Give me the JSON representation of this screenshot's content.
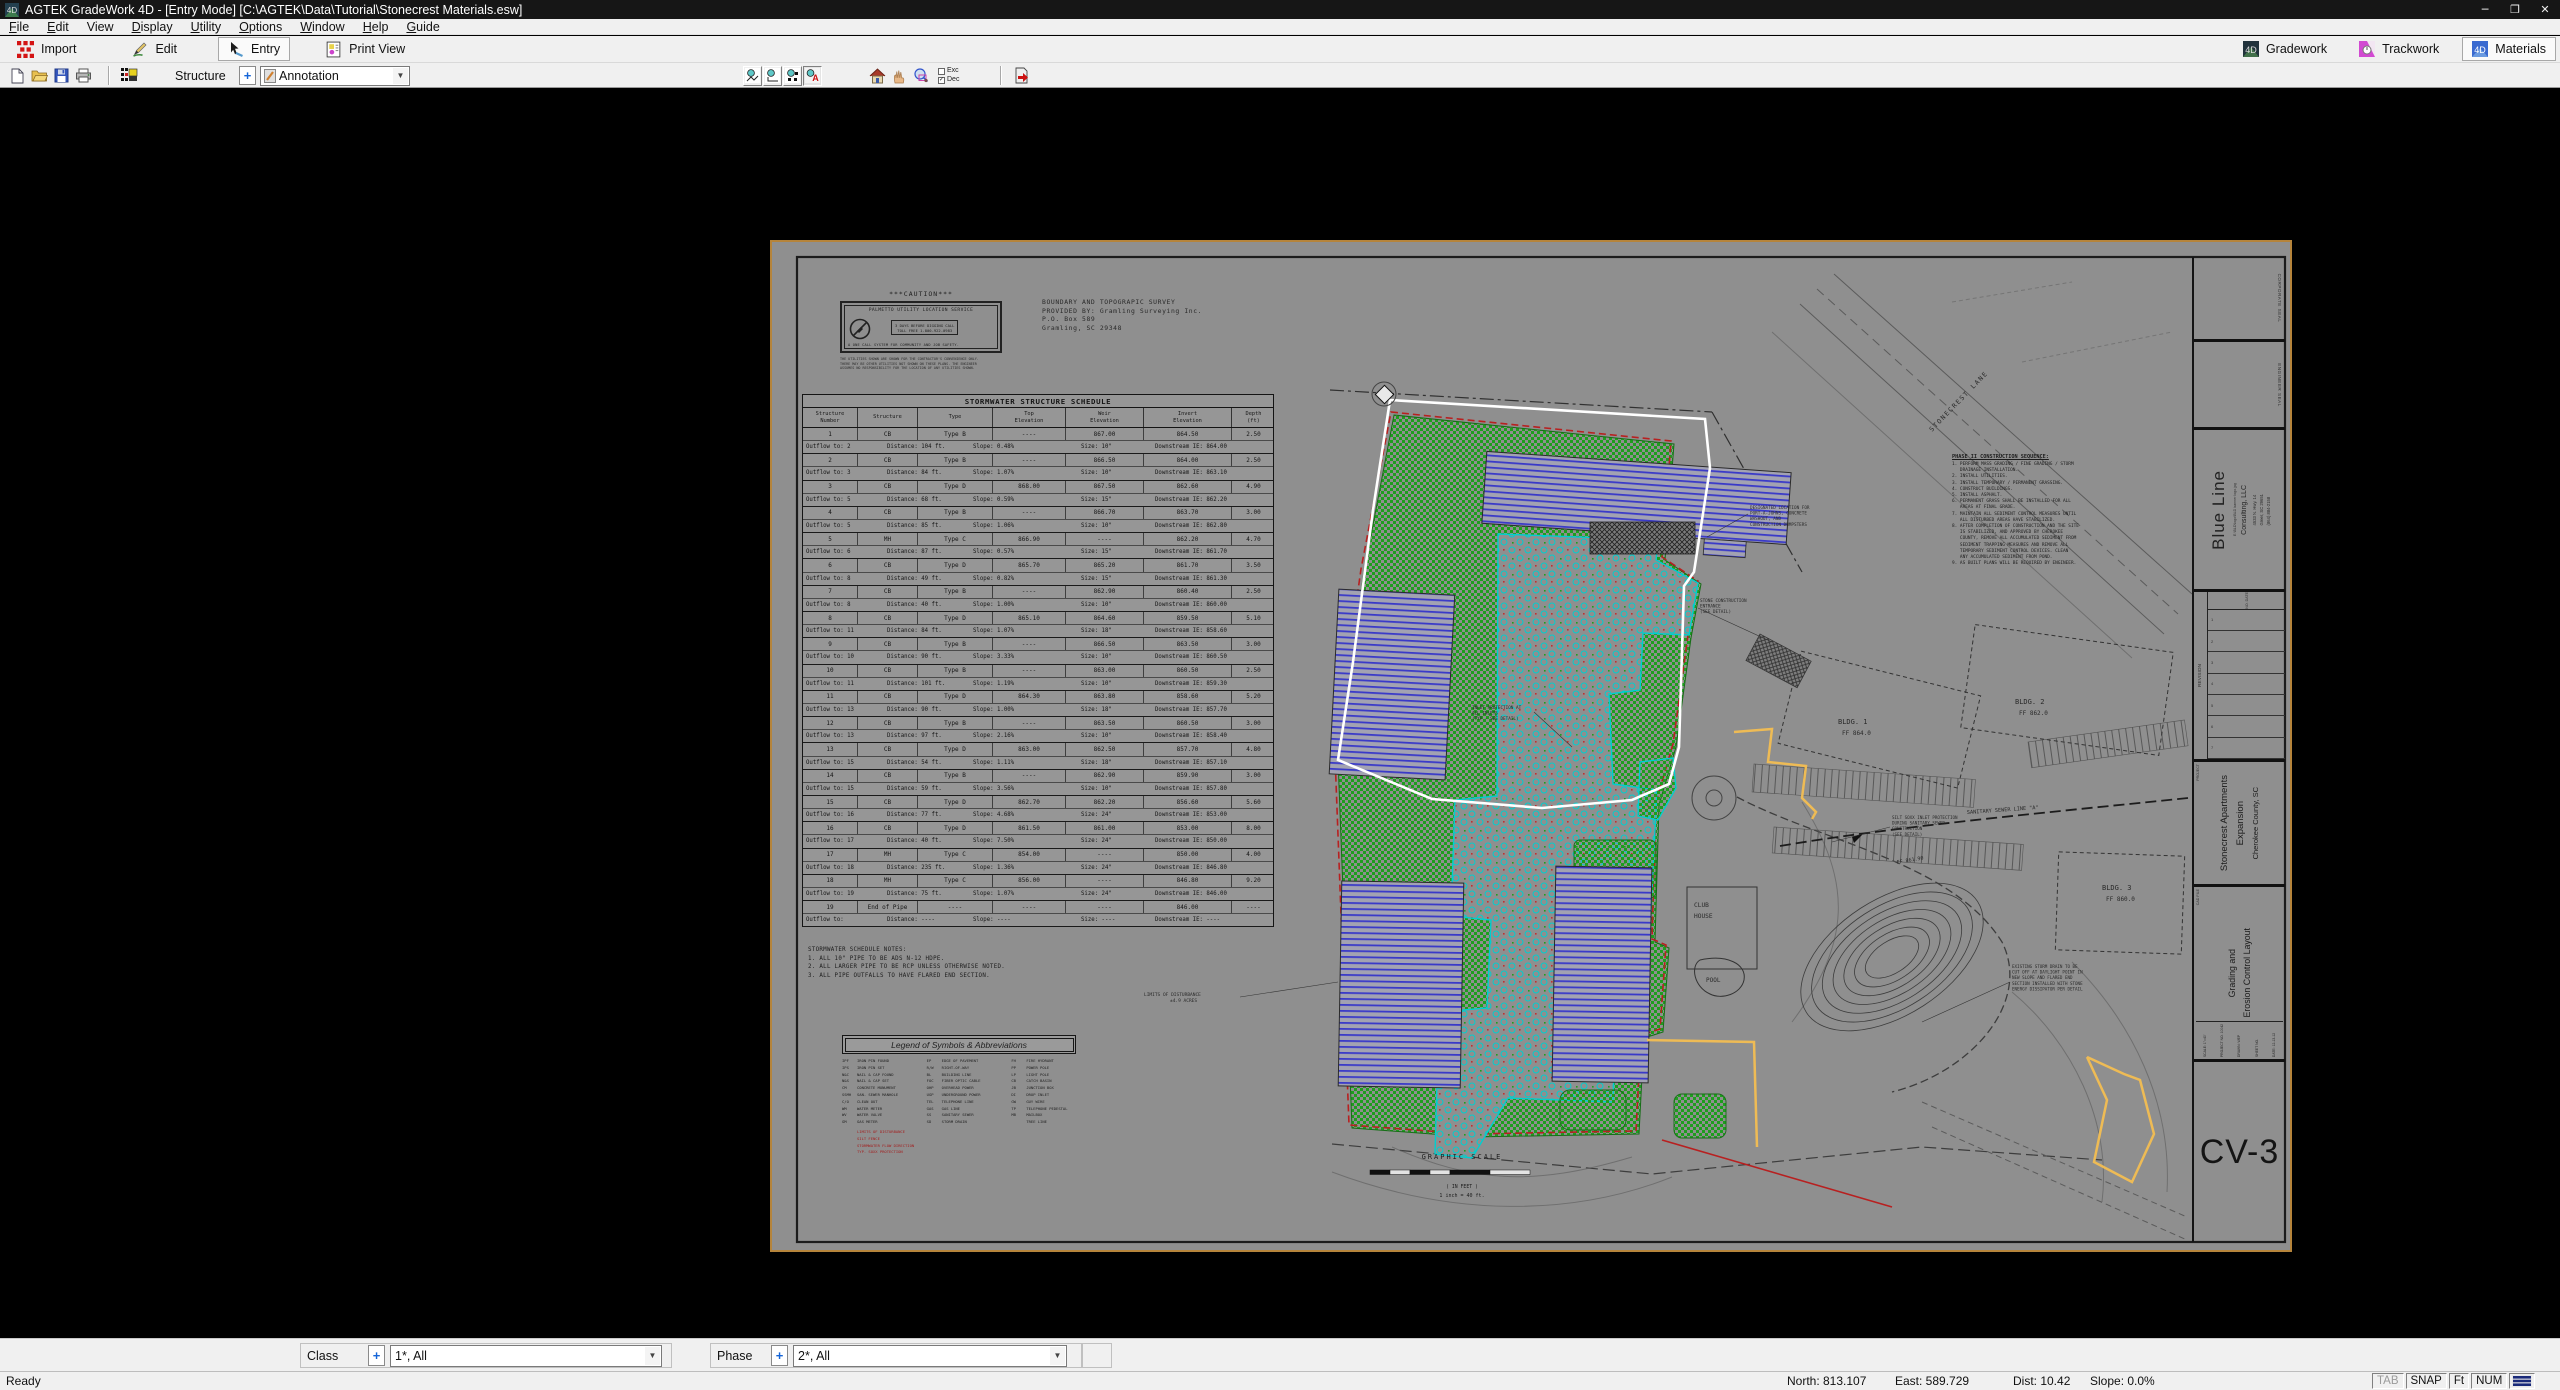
{
  "window": {
    "title": "AGTEK GradeWork 4D - [Entry Mode]  [C:\\AGTEK\\Data\\Tutorial\\Stonecrest Materials.esw]",
    "minimize": "─",
    "maximize": "❐",
    "close": "✕"
  },
  "menus": [
    {
      "u": "F",
      "rest": "ile"
    },
    {
      "u": "E",
      "rest": "dit"
    },
    {
      "u": "",
      "rest": "View"
    },
    {
      "u": "D",
      "rest": "isplay"
    },
    {
      "u": "U",
      "rest": "tility"
    },
    {
      "u": "O",
      "rest": "ptions"
    },
    {
      "u": "W",
      "rest": "indow"
    },
    {
      "u": "H",
      "rest": "elp"
    },
    {
      "u": "G",
      "rest": "uide"
    }
  ],
  "toolbar": {
    "import": "Import",
    "edit": "Edit",
    "entry": "Entry",
    "print_view": "Print View",
    "gradework": "Gradework",
    "trackwork": "Trackwork",
    "materials": "Materials"
  },
  "entrybar": {
    "structure_label": "Structure",
    "plus": "+",
    "layer_value": "Annotation",
    "exc": "Exc",
    "dec": "Dec",
    "dec_check": "✓",
    "arrow": "▼"
  },
  "bottombar": {
    "class_label": "Class",
    "class_value": "1*, All",
    "phase_label": "Phase",
    "phase_value": "2*, All",
    "plus": "+",
    "arrow": "▼"
  },
  "status": {
    "ready": "Ready",
    "north": "North: 813.107",
    "east": "East: 589.729",
    "dist": "Dist: 10.42",
    "slope": "Slope: 0.0%",
    "tab": "TAB",
    "snap": "SNAP",
    "ft": "Ft",
    "num": "NUM"
  },
  "colors": {
    "seed_green": "#1e9e1e",
    "pavement_cyan": "#00cfcf",
    "silt_fence_red": "#b82020",
    "annotation_yellow": "#eebb55",
    "takeoff_white": "#ffffff",
    "sheet_frame": "#b5843b",
    "building_stripe_blue": "#3a3ac8"
  },
  "sheet": {
    "caution": {
      "title": "***CAUTION***",
      "service": "PALMETTO UTILITY LOCATION SERVICE",
      "call1": "3 DAYS BEFORE DIGGING CALL",
      "call2": "TOLL FREE 1-800-922-0983",
      "footer": "A ONE CALL SYSTEM FOR COMMUNITY AND JOB SAFETY.",
      "smallprint": [
        "THE UTILITIES SHOWN ARE SHOWN FOR THE CONTRACTOR'S CONVENIENCE ONLY.",
        "THERE MAY BE OTHER UTILITIES NOT SHOWN ON THESE PLANS. THE ENGINEER",
        "ASSUMES NO RESPONSIBILITY FOR THE LOCATION OF ANY UTILITIES SHOWN."
      ]
    },
    "survey": [
      "BOUNDARY AND TOPOGRAPIC SURVEY",
      "PROVIDED BY: Gramling Surveying Inc.",
      "P.O. Box 589",
      "Gramling, SC 29348"
    ],
    "schedule": {
      "title": "STORMWATER STRUCTURE SCHEDULE",
      "headers": [
        {
          "l1": "Structure",
          "l2": "Number"
        },
        {
          "l1": "",
          "l2": "Structure"
        },
        {
          "l1": "",
          "l2": "Type"
        },
        {
          "l1": "Top",
          "l2": "Elevation"
        },
        {
          "l1": "Weir",
          "l2": "Elevation"
        },
        {
          "l1": "Invert",
          "l2": "Elevation"
        },
        {
          "l1": "Depth",
          "l2": "(ft)"
        }
      ],
      "rows": [
        {
          "n": "1",
          "s": "CB",
          "t": "Type B",
          "top": "----",
          "weir": "867.00",
          "inv": "864.50",
          "d": "2.50",
          "o": [
            "Outflow to:   2",
            "Distance: 104 ft.",
            "Slope: 0.48%",
            "Size: 10\"",
            "Downstream IE: 864.00"
          ]
        },
        {
          "n": "2",
          "s": "CB",
          "t": "Type B",
          "top": "----",
          "weir": "866.50",
          "inv": "864.00",
          "d": "2.50",
          "o": [
            "Outflow to:   3",
            "Distance: 84 ft.",
            "Slope: 1.07%",
            "Size: 10\"",
            "Downstream IE: 863.10"
          ]
        },
        {
          "n": "3",
          "s": "CB",
          "t": "Type D",
          "top": "868.00",
          "weir": "867.50",
          "inv": "862.60",
          "d": "4.90",
          "o": [
            "Outflow to:   5",
            "Distance: 68 ft.",
            "Slope: 0.59%",
            "Size: 15\"",
            "Downstream IE: 862.20"
          ]
        },
        {
          "n": "4",
          "s": "CB",
          "t": "Type B",
          "top": "----",
          "weir": "866.70",
          "inv": "863.70",
          "d": "3.00",
          "o": [
            "Outflow to:   5",
            "Distance: 85 ft.",
            "Slope: 1.06%",
            "Size: 10\"",
            "Downstream IE: 862.80"
          ]
        },
        {
          "n": "5",
          "s": "MH",
          "t": "Type C",
          "top": "866.90",
          "weir": "----",
          "inv": "862.20",
          "d": "4.70",
          "o": [
            "Outflow to:   6",
            "Distance: 87 ft.",
            "Slope: 0.57%",
            "Size: 15\"",
            "Downstream IE: 861.70"
          ]
        },
        {
          "n": "6",
          "s": "CB",
          "t": "Type D",
          "top": "865.70",
          "weir": "865.20",
          "inv": "861.70",
          "d": "3.50",
          "o": [
            "Outflow to:   8",
            "Distance: 49 ft.",
            "Slope: 0.82%",
            "Size: 15\"",
            "Downstream IE: 861.30"
          ]
        },
        {
          "n": "7",
          "s": "CB",
          "t": "Type B",
          "top": "----",
          "weir": "862.90",
          "inv": "860.40",
          "d": "2.50",
          "o": [
            "Outflow to:   8",
            "Distance: 40 ft.",
            "Slope: 1.00%",
            "Size: 10\"",
            "Downstream IE: 860.00"
          ]
        },
        {
          "n": "8",
          "s": "CB",
          "t": "Type D",
          "top": "865.10",
          "weir": "864.60",
          "inv": "859.50",
          "d": "5.10",
          "o": [
            "Outflow to:  11",
            "Distance: 84 ft.",
            "Slope: 1.07%",
            "Size: 18\"",
            "Downstream IE: 858.60"
          ]
        },
        {
          "n": "9",
          "s": "CB",
          "t": "Type B",
          "top": "----",
          "weir": "866.50",
          "inv": "863.50",
          "d": "3.00",
          "o": [
            "Outflow to:  10",
            "Distance: 90 ft.",
            "Slope: 3.33%",
            "Size: 10\"",
            "Downstream IE: 860.50"
          ]
        },
        {
          "n": "10",
          "s": "CB",
          "t": "Type B",
          "top": "----",
          "weir": "863.00",
          "inv": "860.50",
          "d": "2.50",
          "o": [
            "Outflow to:  11",
            "Distance: 101 ft.",
            "Slope: 1.19%",
            "Size: 10\"",
            "Downstream IE: 859.30"
          ]
        },
        {
          "n": "11",
          "s": "CB",
          "t": "Type D",
          "top": "864.30",
          "weir": "863.80",
          "inv": "858.60",
          "d": "5.20",
          "o": [
            "Outflow to:  13",
            "Distance: 90 ft.",
            "Slope: 1.00%",
            "Size: 18\"",
            "Downstream IE: 857.70"
          ]
        },
        {
          "n": "12",
          "s": "CB",
          "t": "Type B",
          "top": "----",
          "weir": "863.50",
          "inv": "860.50",
          "d": "3.00",
          "o": [
            "Outflow to:  13",
            "Distance: 97 ft.",
            "Slope: 2.16%",
            "Size: 10\"",
            "Downstream IE: 858.40"
          ]
        },
        {
          "n": "13",
          "s": "CB",
          "t": "Type D",
          "top": "863.00",
          "weir": "862.50",
          "inv": "857.70",
          "d": "4.80",
          "o": [
            "Outflow to:  15",
            "Distance: 54 ft.",
            "Slope: 1.11%",
            "Size: 18\"",
            "Downstream IE: 857.10"
          ]
        },
        {
          "n": "14",
          "s": "CB",
          "t": "Type B",
          "top": "----",
          "weir": "862.90",
          "inv": "859.90",
          "d": "3.00",
          "o": [
            "Outflow to:  15",
            "Distance: 59 ft.",
            "Slope: 3.56%",
            "Size: 10\"",
            "Downstream IE: 857.80"
          ]
        },
        {
          "n": "15",
          "s": "CB",
          "t": "Type D",
          "top": "862.70",
          "weir": "862.20",
          "inv": "856.60",
          "d": "5.60",
          "o": [
            "Outflow to:  16",
            "Distance: 77 ft.",
            "Slope: 4.68%",
            "Size: 24\"",
            "Downstream IE: 853.00"
          ]
        },
        {
          "n": "16",
          "s": "CB",
          "t": "Type D",
          "top": "861.50",
          "weir": "861.00",
          "inv": "853.00",
          "d": "8.00",
          "o": [
            "Outflow to:  17",
            "Distance: 40 ft.",
            "Slope: 7.50%",
            "Size: 24\"",
            "Downstream IE: 850.00"
          ]
        },
        {
          "n": "17",
          "s": "MH",
          "t": "Type C",
          "top": "854.00",
          "weir": "----",
          "inv": "850.00",
          "d": "4.00",
          "o": [
            "Outflow to:  18",
            "Distance: 235 ft.",
            "Slope: 1.36%",
            "Size: 24\"",
            "Downstream IE: 846.80"
          ]
        },
        {
          "n": "18",
          "s": "MH",
          "t": "Type C",
          "top": "856.00",
          "weir": "----",
          "inv": "846.80",
          "d": "9.20",
          "o": [
            "Outflow to:  19",
            "Distance: 75 ft.",
            "Slope: 1.07%",
            "Size: 24\"",
            "Downstream IE: 846.00"
          ]
        },
        {
          "n": "19",
          "s": "End of Pipe",
          "t": "----",
          "top": "----",
          "weir": "----",
          "inv": "846.00",
          "d": "----",
          "o": [
            "Outflow to:",
            "Distance: ----",
            "Slope: ----",
            "Size: ----",
            "Downstream IE: ----"
          ]
        }
      ]
    },
    "notes": {
      "title": "STORMWATER SCHEDULE NOTES:",
      "lines": [
        "1.  ALL 10\" PIPE TO BE ADS N-12 HDPE.",
        "2.  ALL LARGER PIPE TO BE RCP UNLESS OTHERWISE NOTED.",
        "3.  ALL PIPE OUTFALLS TO HAVE FLARED END SECTION."
      ]
    },
    "legend": {
      "title": "Legend of Symbols & Abbreviations",
      "col1": [
        {
          "a": "IPF",
          "d": "IRON PIN FOUND"
        },
        {
          "a": "IPS",
          "d": "IRON PIN SET"
        },
        {
          "a": "N&C",
          "d": "NAIL & CAP FOUND"
        },
        {
          "a": "N&S",
          "d": "NAIL & CAP SET"
        },
        {
          "a": "CM",
          "d": "CONCRETE MONUMENT"
        },
        {
          "a": "SSMH",
          "d": "SAN. SEWER MANHOLE"
        },
        {
          "a": "C/O",
          "d": "CLEAN OUT"
        },
        {
          "a": "WM",
          "d": "WATER METER"
        },
        {
          "a": "WV",
          "d": "WATER VALVE"
        },
        {
          "a": "GM",
          "d": "GAS METER"
        }
      ],
      "col2": [
        {
          "a": "EP",
          "d": "EDGE OF PAVEMENT"
        },
        {
          "a": "R/W",
          "d": "RIGHT-OF-WAY"
        },
        {
          "a": "BL",
          "d": "BUILDING LINE"
        },
        {
          "a": "FOC",
          "d": "FIBER OPTIC CABLE"
        },
        {
          "a": "OHP",
          "d": "OVERHEAD POWER"
        },
        {
          "a": "UGP",
          "d": "UNDERGROUND POWER"
        },
        {
          "a": "TEL",
          "d": "TELEPHONE LINE"
        },
        {
          "a": "GAS",
          "d": "GAS LINE"
        },
        {
          "a": "SS",
          "d": "SANITARY SEWER"
        },
        {
          "a": "SD",
          "d": "STORM DRAIN"
        }
      ],
      "col3": [
        {
          "a": "FH",
          "d": "FIRE HYDRANT"
        },
        {
          "a": "PP",
          "d": "POWER POLE"
        },
        {
          "a": "LP",
          "d": "LIGHT POLE"
        },
        {
          "a": "CB",
          "d": "CATCH BASIN"
        },
        {
          "a": "JB",
          "d": "JUNCTION BOX"
        },
        {
          "a": "DI",
          "d": "DROP INLET"
        },
        {
          "a": "GW",
          "d": "GUY WIRE"
        },
        {
          "a": "TP",
          "d": "TELEPHONE PEDESTAL"
        },
        {
          "a": "MB",
          "d": "MAILBOX"
        },
        {
          "a": "",
          "d": "TREE LINE"
        }
      ],
      "red_items": [
        {
          "a": "",
          "d": "LIMITS OF DISTURBANCE"
        },
        {
          "a": "",
          "d": "SILT FENCE"
        },
        {
          "a": "",
          "d": "STORMWATER FLOW DIRECTION"
        },
        {
          "a": "",
          "d": "TYP. SOXX PROTECTION"
        }
      ]
    },
    "phase2": {
      "title": "PHASE II CONSTRUCTION SEQUENCE:",
      "lines": [
        "1. PERFORM MASS GRADING / FINE GRADING / STORM",
        "   DRAINAGE INSTALLATION.",
        "2. INSTALL UTILITIES.",
        "3. INSTALL TEMPORARY / PERMANENT GRASSING.",
        "4. CONSTRUCT BUILDINGS.",
        "5. INSTALL ASPHALT.",
        "6. PERMANENT GRASS SHALL BE INSTALLED FOR ALL",
        "   AREAS AT FINAL GRADE.",
        "7. MAINTAIN ALL SEDIMENT CONTROL MEASURES UNTIL",
        "   ALL DISTURBED AREAS HAVE STABILIZED.",
        "8. AFTER COMPLETION OF CONSTRUCTION AND THE SITE",
        "   IS STABILIZED, AND APPROVED BY CHEROKEE",
        "   COUNTY, REMOVE ALL ACCUMULATED SEDIMENT FROM",
        "   SEDIMENT TRAPPING MEASURES AND REMOVE ALL",
        "   TEMPORARY SEDIMENT CONTROL DEVICES. CLEAN",
        "   ANY ACCUMULATED SEDIMENT FROM POND.",
        "9. AS BUILT PLANS WILL BE REQUIRED BY ENGINEER."
      ]
    },
    "plan": {
      "stonecrest_lane": "STONECREST LANE",
      "sewer": "SANITARY SEWER LINE \"A\"",
      "bldg1": "BLDG. 1",
      "bldg1_ff": "FF  864.0",
      "bldg2": "BLDG. 2",
      "bldg2_ff": "FF  862.0",
      "bldg3": "BLDG. 3",
      "bldg3_ff": "FF  860.0",
      "club1": "CLUB",
      "club2": "HOUSE",
      "pool": "POOL",
      "ff_mid": "FF  861.90",
      "designated": [
        "DESIGNATED LOCATION FOR",
        "PORT-A-JOHNS, CONCRETE",
        "WASHOUT, AND",
        "CONSTRUCTION DUMPSTERS"
      ],
      "stone_entrance": [
        "STONE CONSTRUCTION",
        "ENTRANCE",
        "(SEE DETAIL)"
      ],
      "inlet": [
        "INLET PROTECTION AT",
        "ALL INLETS",
        "(TYP - SEE DETAIL)"
      ],
      "limits1": "LIMITS OF DISTURBANCE",
      "limits2": "±4.9 ACRES",
      "silt_soxx": [
        "SILT SOXX INLET PROTECTION",
        "DURING SANITARY SEWER",
        "CONSTRUCTION",
        "(SEE DETAIL)"
      ],
      "storm_cut": [
        "EXISTING STORM DRAIN TO BE",
        "CUT OFF AT DAYLIGHT POINT IN",
        "NEW SLOPE AND FLARED END",
        "SECTION INSTALLED WITH STONE",
        "ENERGY DISSIPATOR PER DETAIL"
      ],
      "scale_title": "GRAPHIC SCALE",
      "scale_feet": "( IN FEET )",
      "scale_inch": "1 inch = 40 ft."
    },
    "titleblock": {
      "corporate_seal": "CORPORATE SEAL",
      "engineer_seal": "ENGINEER SEAL",
      "firm_name": "Blue Line",
      "firm_logo_path": "E:\\BLD\\logo\\BLD banner logo.jpg",
      "firm_sub": "Consulting, LLC",
      "addr1": "4533 N. Hwy. 14",
      "addr2": "Greer, SC 29651",
      "phone": "(864) 884-2158",
      "revision": "REVISION",
      "rev_no": "NO.  DATE",
      "rev_rows": [
        "1",
        "2",
        "3",
        "4",
        "5",
        "6",
        "7"
      ],
      "project_label": "PROJECT",
      "project1": "Stonecrest Apartments",
      "project2": "Expansion",
      "project_loc": "Cherokee County, SC",
      "cad_file": "CAD FILE",
      "sheet_title1": "Grading and",
      "sheet_title2": "Erosion Control Layout",
      "scale": "SCALE: 1\"=40'",
      "project_no": "PROJECT NO. 10042",
      "drawn": "DRAWN: WEP",
      "sheet_no_label": "SHEET NO.",
      "date": "DATE: 12-13-12",
      "sheet_no": "CV-3"
    }
  }
}
